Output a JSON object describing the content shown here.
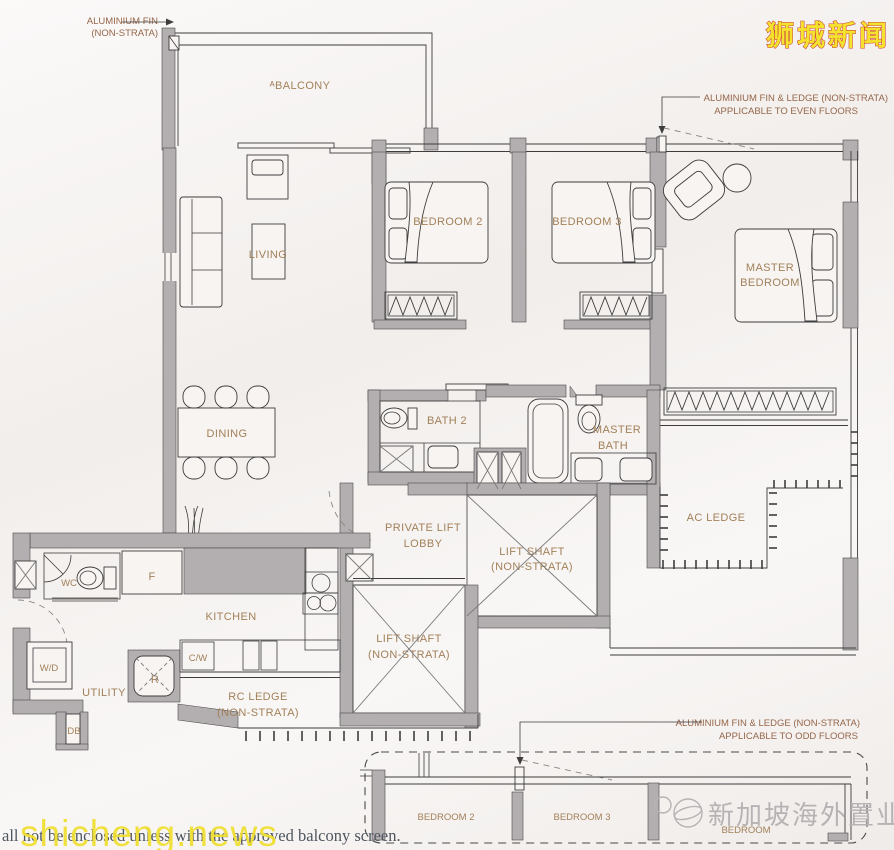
{
  "watermarks": {
    "top_right": "狮城新闻",
    "bottom_left": "shicheng.news",
    "bottom_right": "新加坡海外置业"
  },
  "caption": "all not be enclosed unless with the approved balcony screen.",
  "annotations": {
    "aluminium_fin": {
      "line1": "ALUMINIUM FIN",
      "line2": "(NON-STRATA)"
    },
    "even_floors": {
      "line1": "ALUMINIUM FIN & LEDGE (NON-STRATA)",
      "line2": "APPLICABLE TO EVEN FLOORS"
    },
    "odd_floors": {
      "line1": "ALUMINIUM FIN & LEDGE (NON-STRATA)",
      "line2": "APPLICABLE TO ODD FLOORS"
    }
  },
  "rooms": {
    "balcony": "ᴬBALCONY",
    "living": "LIVING",
    "dining": "DINING",
    "bedroom2": "BEDROOM 2",
    "bedroom3": "BEDROOM 3",
    "master_bedroom": {
      "line1": "MASTER",
      "line2": "BEDROOM"
    },
    "bath2": "BATH 2",
    "master_bath": {
      "line1": "MASTER",
      "line2": "BATH"
    },
    "ac_ledge": "AC LEDGE",
    "private_lift_lobby": {
      "line1": "PRIVATE LIFT",
      "line2": "LOBBY"
    },
    "lift_shaft": {
      "line1": "LIFT SHAFT",
      "line2": "(NON-STRATA)"
    },
    "kitchen": "KITCHEN",
    "wc": "WC",
    "fridge": "F",
    "cooker_washer": "C/W",
    "washer_dryer": "W/D",
    "utility": "UTILITY",
    "refuse_chute": "R",
    "rc_ledge": {
      "line1": "RC LEDGE",
      "line2": "(NON-STRATA)"
    },
    "db": "DB"
  },
  "lower_plan": {
    "bedroom2": "BEDROOM 2",
    "bedroom3": "BEDROOM 3",
    "bedroom": "BEDROOM"
  },
  "colors": {
    "wall": "#b3aeb0",
    "line": "#3d3d3d",
    "room_label": "#a28059",
    "annotation": "#96664a",
    "paper": "#f6f3f1",
    "watermark_yellow": "#f5e22e",
    "watermark_red": "#cc4433",
    "watermark_gray": "#b7b2b4",
    "caption_text": "#4e565f"
  }
}
